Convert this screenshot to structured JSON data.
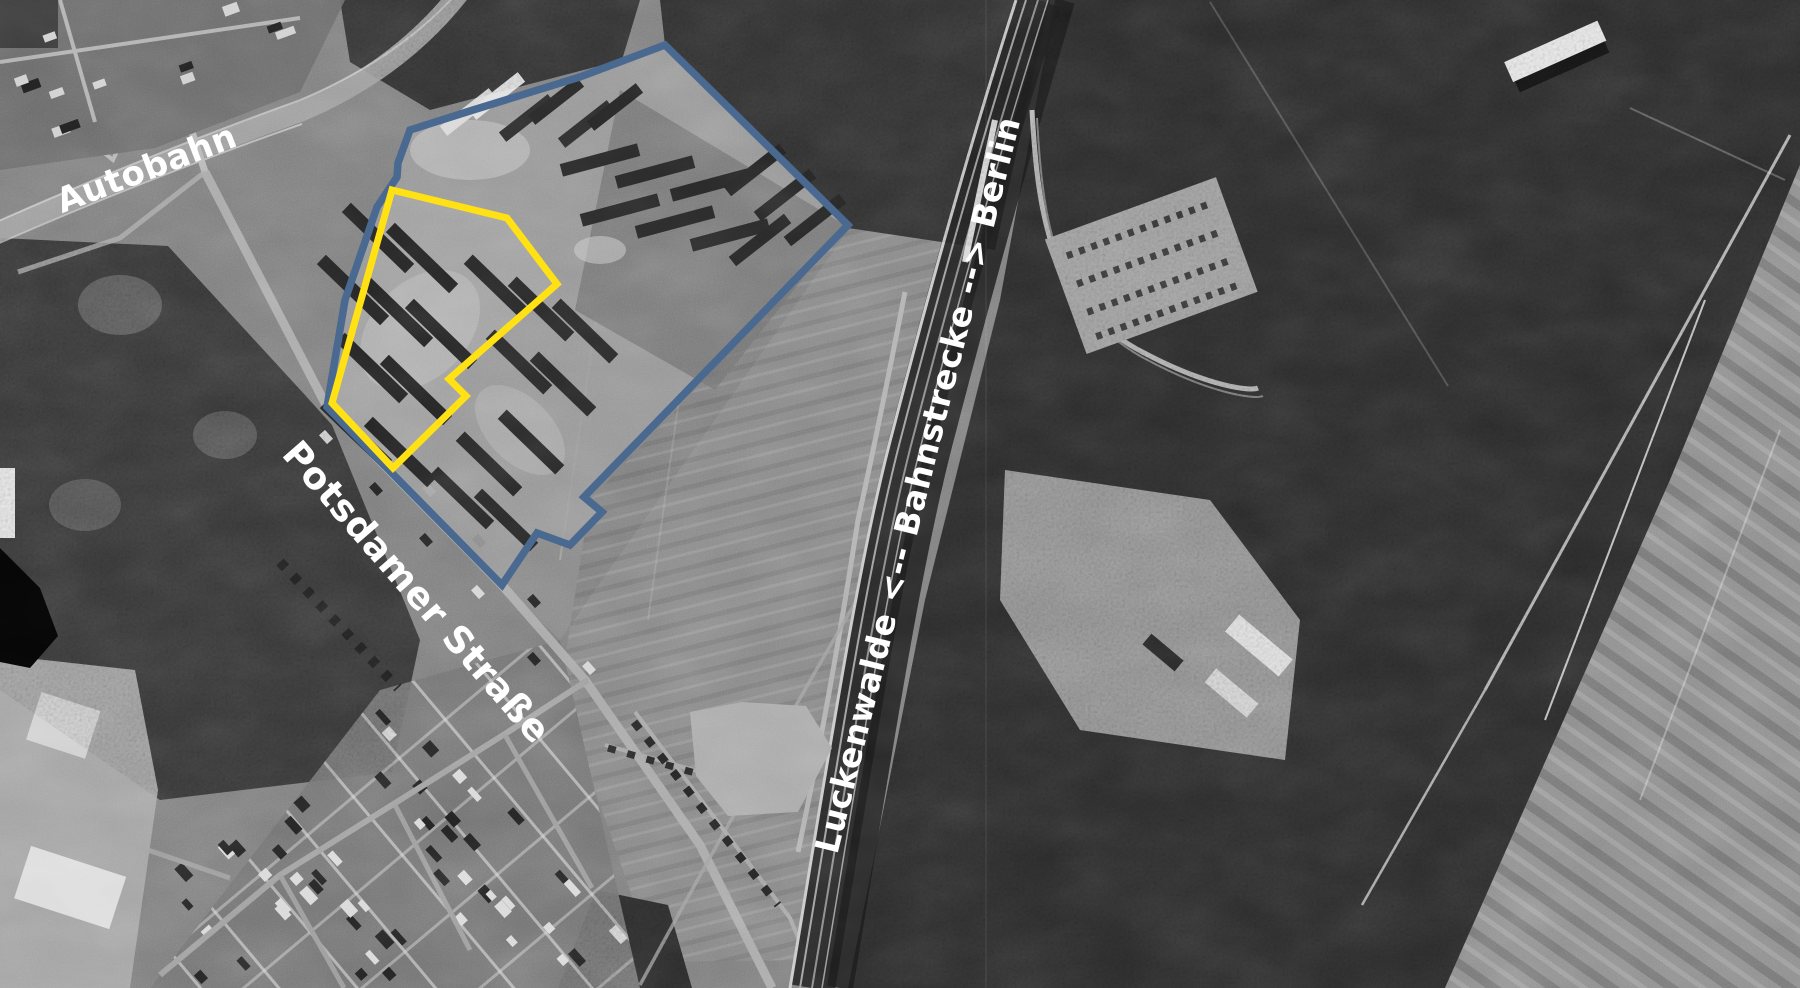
{
  "map": {
    "title": "aerial-photo-annotated",
    "labels": {
      "autobahn": "Autobahn",
      "street": "Potsdamer Straße",
      "railway": "Luckenwalde <-- Bahnstrecke --> Berlin"
    },
    "overlays": {
      "blue_outline_label": "site-boundary-blue",
      "blue_color": "#4a6990",
      "yellow_outline_label": "site-boundary-yellow",
      "yellow_color": "#ffe114"
    },
    "photo": {
      "style": "black-and-white aerial photograph",
      "tones": {
        "field_gray": "#7d7d7d",
        "forest_dark": "#2f2f2f",
        "road_light": "#a8a8a8",
        "building_light": "#e0e0e0",
        "building_dark": "#242424"
      }
    }
  }
}
